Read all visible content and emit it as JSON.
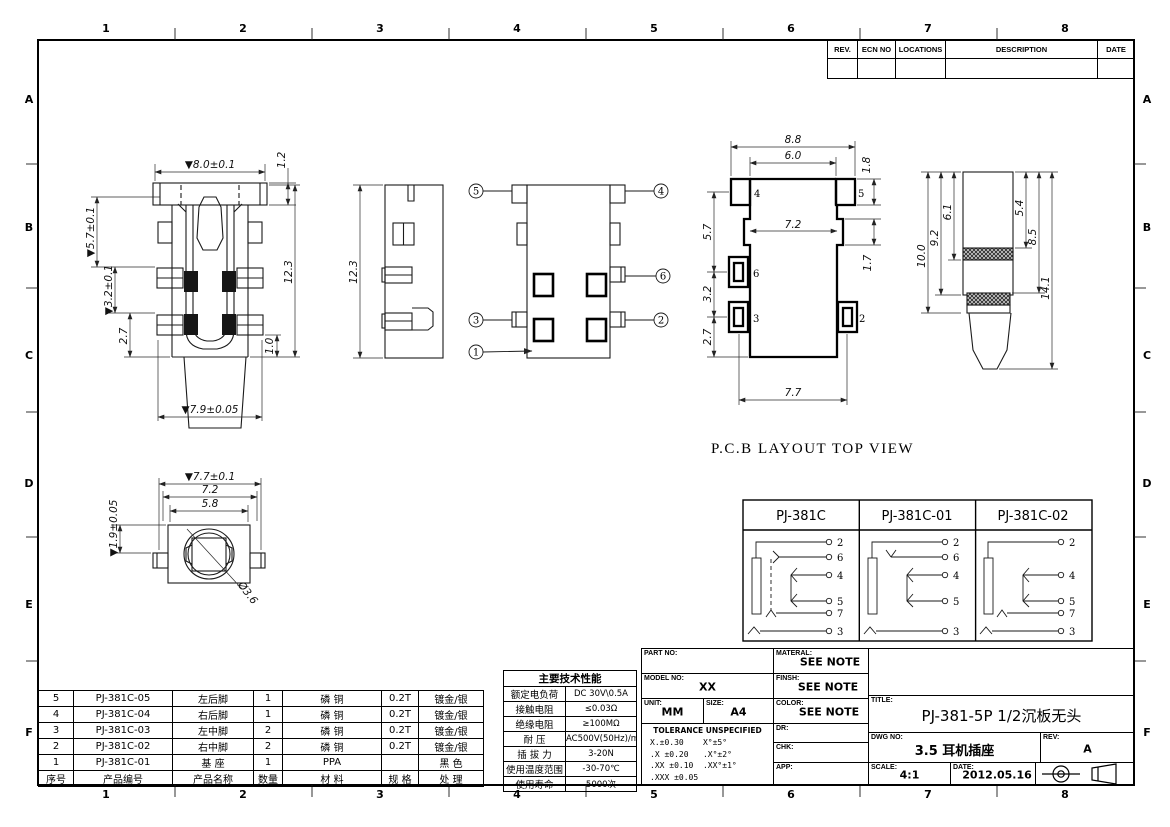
{
  "sheet": {
    "zone_cols": [
      "1",
      "2",
      "3",
      "4",
      "5",
      "6",
      "7",
      "8"
    ],
    "zone_rows": [
      "A",
      "B",
      "C",
      "D",
      "E",
      "F"
    ]
  },
  "revision_table": {
    "headers": [
      "REV.",
      "ECN NO",
      "LOCATIONS",
      "DESCRIPTION",
      "DATE"
    ]
  },
  "views": {
    "front": {
      "dim_width_top": "▼8.0±0.1",
      "dim_flange": "1.2",
      "dim_h1": "▼5.7±0.1",
      "dim_h2": "▼3.2±0.1",
      "dim_h3": "2.7",
      "dim_height": "12.3",
      "dim_pin": "1.0",
      "dim_width_bottom": "▼7.9±0.05"
    },
    "side": {
      "dim_height": "12.3"
    },
    "bottom": {
      "callouts": [
        "1",
        "2",
        "3",
        "4",
        "5",
        "6"
      ]
    },
    "pcb": {
      "caption": "P.C.B LAYOUT TOP VIEW",
      "dim_w1": "8.8",
      "dim_w2": "6.0",
      "dim_pad": "1.8",
      "dim_w3": "7.2",
      "dim_step": "1.7",
      "dim_h1": "5.7",
      "dim_h2": "3.2",
      "dim_h3": "2.7",
      "dim_w4": "7.7",
      "pads": [
        "4",
        "5",
        "6",
        "3",
        "2"
      ]
    },
    "plug": {
      "dim_l1": "10.0",
      "dim_l2": "9.2",
      "dim_l3": "6.1",
      "dim_r1": "5.4",
      "dim_r2": "8.5",
      "dim_r3": "14.1"
    },
    "front_face": {
      "dim_w1": "▼7.7±0.1",
      "dim_w2": "7.2",
      "dim_w3": "5.8",
      "dim_h": "▼1.9±0.05",
      "dim_dia": "Ø3.6"
    }
  },
  "circuit_table": {
    "columns": [
      {
        "title": "PJ-381C",
        "pins": [
          "2",
          "6",
          "4",
          "5",
          "7",
          "3"
        ]
      },
      {
        "title": "PJ-381C-01",
        "pins": [
          "2",
          "6",
          "4",
          "5",
          "3"
        ]
      },
      {
        "title": "PJ-381C-02",
        "pins": [
          "2",
          "4",
          "5",
          "7",
          "3"
        ]
      }
    ]
  },
  "spec_table": {
    "title": "主要技术性能",
    "rows": [
      {
        "label": "额定电负荷",
        "value": "DC 30V\\0.5A"
      },
      {
        "label": "接触电阻",
        "value": "≤0.03Ω"
      },
      {
        "label": "绝缘电阻",
        "value": "≥100MΩ"
      },
      {
        "label": "耐  压",
        "value": "AC500V(50Hz)/min"
      },
      {
        "label": "插 拔 力",
        "value": "3-20N"
      },
      {
        "label": "使用温度范围",
        "value": "-30-70℃"
      },
      {
        "label": "使用寿命",
        "value": "5000次"
      }
    ]
  },
  "parts_table": {
    "headers": [
      "序号",
      "产品编号",
      "产品名称",
      "数量",
      "材 料",
      "规 格",
      "处 理"
    ],
    "rows": [
      [
        "5",
        "PJ-381C-05",
        "左后脚",
        "1",
        "磷 铜",
        "0.2T",
        "镀金/银"
      ],
      [
        "4",
        "PJ-381C-04",
        "右后脚",
        "1",
        "磷 铜",
        "0.2T",
        "镀金/银"
      ],
      [
        "3",
        "PJ-381C-03",
        "左中脚",
        "2",
        "磷 铜",
        "0.2T",
        "镀金/银"
      ],
      [
        "2",
        "PJ-381C-02",
        "右中脚",
        "2",
        "磷 铜",
        "0.2T",
        "镀金/银"
      ],
      [
        "1",
        "PJ-381C-01",
        "基 座",
        "1",
        "PPA",
        "",
        "黑 色"
      ]
    ]
  },
  "title_block": {
    "part_no_label": "PART NO:",
    "model_no_label": "MODEL NO:",
    "model_no": "XX",
    "unit_label": "UNIT:",
    "unit": "MM",
    "size_label": "SIZE:",
    "size": "A4",
    "tolerance_title": "TOLERANCE UNSPECIFIED",
    "tol_line1": "X.±0.30    X°±5°",
    "tol_line2": ".X ±0.20   .X°±2°",
    "tol_line3": ".XX ±0.10  .XX°±1°",
    "tol_line4": ".XXX ±0.05",
    "material_label": "MATERAL:",
    "material": "SEE NOTE",
    "finish_label": "FINSH:",
    "finish": "SEE NOTE",
    "color_label": "COLOR:",
    "color": "SEE NOTE",
    "dr_label": "DR:",
    "chk_label": "CHK:",
    "app_label": "APP:",
    "title_label": "TITLE:",
    "title": "PJ-381-5P 1/2沉板无头",
    "dwg_label": "DWG NO:",
    "dwg_no": "3.5 耳机插座",
    "rev_label": "REV:",
    "rev": "A",
    "scale_label": "SCALE:",
    "scale": "4:1",
    "date_label": "DATE:",
    "date": "2012.05.16"
  }
}
